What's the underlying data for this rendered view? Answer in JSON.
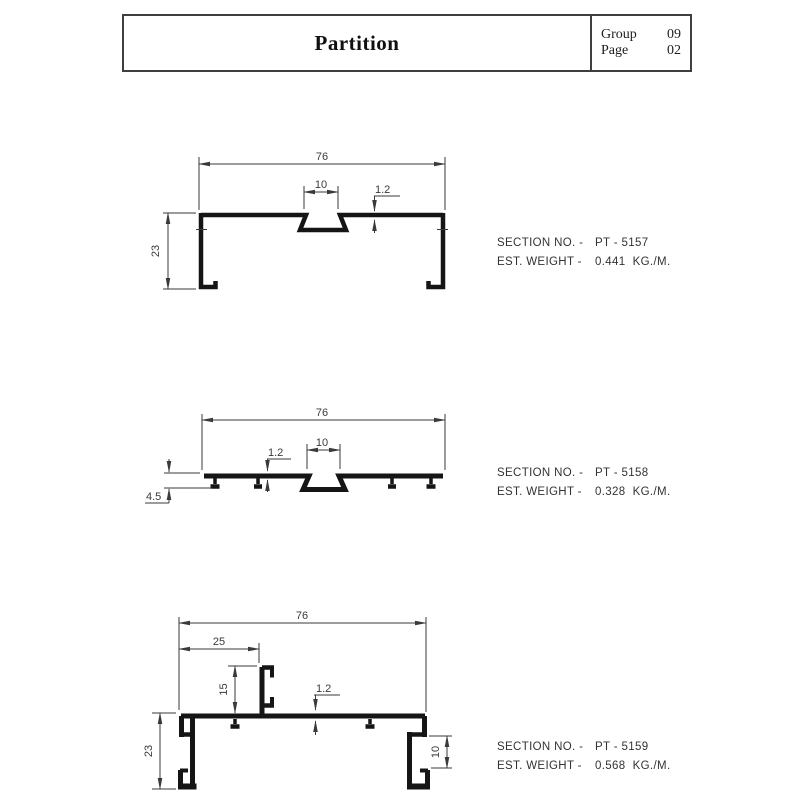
{
  "header": {
    "title": "Partition",
    "group_label": "Group",
    "group_value": "09",
    "page_label": "Page",
    "page_value": "02"
  },
  "drawings": [
    {
      "section_label": "SECTION NO. -",
      "section_value": "PT - 5157",
      "weight_label": "EST. WEIGHT -",
      "weight_value": "0.441  KG./M.",
      "dims": {
        "width": "76",
        "slot_width": "10",
        "wall": "1.2",
        "height": "23"
      }
    },
    {
      "section_label": "SECTION NO. -",
      "section_value": "PT - 5158",
      "weight_label": "EST. WEIGHT -",
      "weight_value": "0.328  KG./M.",
      "dims": {
        "width": "76",
        "slot_width": "10",
        "wall": "1.2",
        "height": "4.5"
      }
    },
    {
      "section_label": "SECTION NO. -",
      "section_value": "PT - 5159",
      "weight_label": "EST. WEIGHT -",
      "weight_value": "0.568  KG./M.",
      "dims": {
        "width": "76",
        "flange_offset": "25",
        "upstand_height": "15",
        "wall": "1.2",
        "height": "23",
        "channel_width": "10"
      }
    }
  ],
  "colors": {
    "ink": "#151515",
    "dim": "#3a3a3a"
  }
}
